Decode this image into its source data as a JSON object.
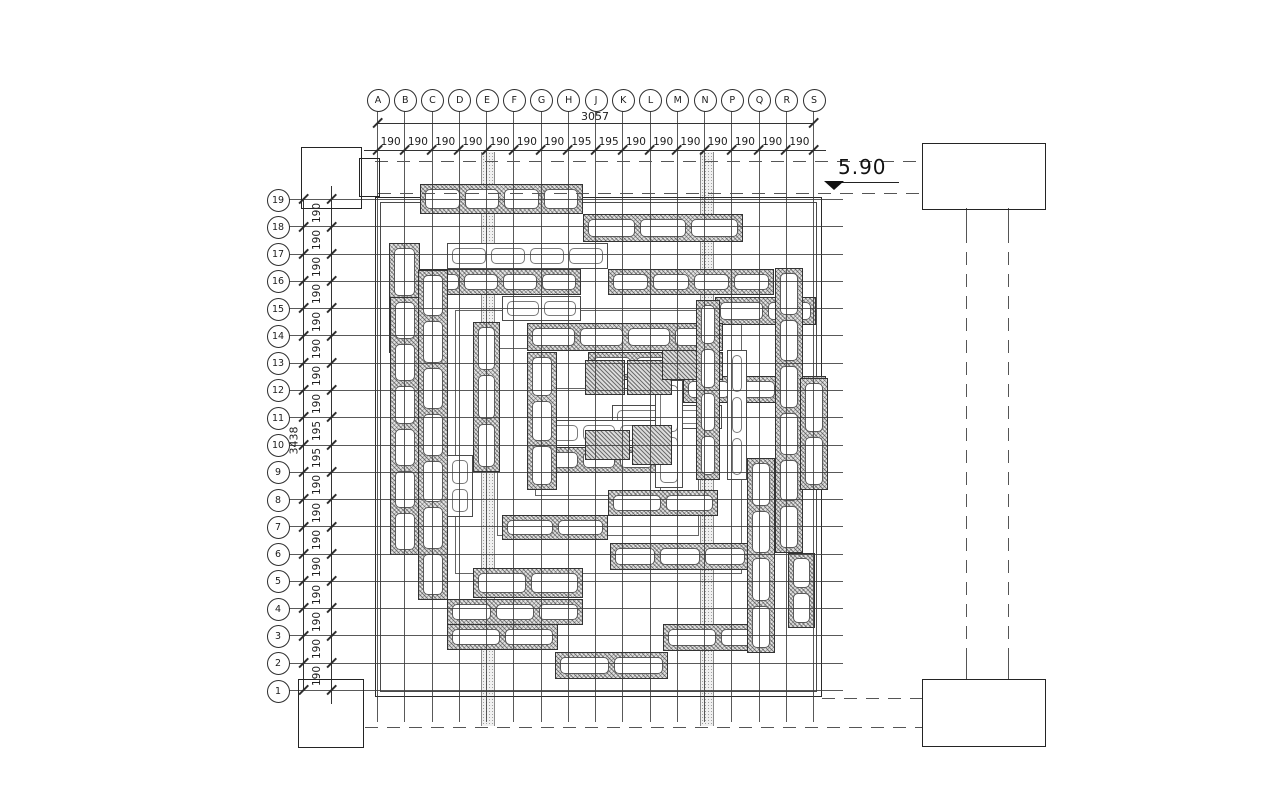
{
  "elevation": {
    "value": "5.90"
  },
  "grid": {
    "top": {
      "labels": [
        "A",
        "B",
        "C",
        "D",
        "E",
        "F",
        "G",
        "H",
        "J",
        "K",
        "L",
        "M",
        "N",
        "P",
        "Q",
        "R",
        "S"
      ],
      "segments": [
        "190",
        "190",
        "190",
        "190",
        "190",
        "190",
        "190",
        "195",
        "195",
        "190",
        "190",
        "190",
        "190",
        "190",
        "190",
        "190"
      ],
      "total": "3057"
    },
    "left": {
      "labels": [
        "19",
        "18",
        "17",
        "16",
        "15",
        "14",
        "13",
        "12",
        "11",
        "10",
        "9",
        "8",
        "7",
        "6",
        "5",
        "4",
        "3",
        "2",
        "1"
      ],
      "segments": [
        "190",
        "190",
        "190",
        "190",
        "190",
        "190",
        "190",
        "190",
        "195",
        "195",
        "190",
        "190",
        "190",
        "190",
        "190",
        "190",
        "190",
        "190"
      ],
      "total": "3438"
    }
  },
  "plan": {
    "boundary": {
      "x": 375,
      "y": 197,
      "w": 445,
      "h": 498
    },
    "bands": [
      {
        "x": 481,
        "y": 152,
        "w": 12,
        "h": 574
      },
      {
        "x": 700,
        "y": 152,
        "w": 12,
        "h": 574
      }
    ],
    "strips": [
      {
        "x": 420,
        "y": 184,
        "w": 163,
        "h": 30,
        "o": "h",
        "s": "dark"
      },
      {
        "x": 583,
        "y": 214,
        "w": 160,
        "h": 28,
        "o": "h",
        "s": "dark"
      },
      {
        "x": 447,
        "y": 243,
        "w": 161,
        "h": 26,
        "o": "h",
        "s": "light"
      },
      {
        "x": 420,
        "y": 269,
        "w": 161,
        "h": 26,
        "o": "h",
        "s": "dark"
      },
      {
        "x": 608,
        "y": 269,
        "w": 166,
        "h": 26,
        "o": "h",
        "s": "dark"
      },
      {
        "x": 502,
        "y": 296,
        "w": 79,
        "h": 25,
        "o": "h",
        "s": "light"
      },
      {
        "x": 715,
        "y": 297,
        "w": 101,
        "h": 28,
        "o": "h",
        "s": "dark"
      },
      {
        "x": 527,
        "y": 323,
        "w": 196,
        "h": 28,
        "o": "h",
        "s": "dark"
      },
      {
        "x": 683,
        "y": 376,
        "w": 143,
        "h": 27,
        "o": "h",
        "s": "dark"
      },
      {
        "x": 612,
        "y": 405,
        "w": 110,
        "h": 24,
        "o": "h",
        "s": "light"
      },
      {
        "x": 540,
        "y": 420,
        "w": 118,
        "h": 26,
        "o": "h",
        "s": "light"
      },
      {
        "x": 540,
        "y": 447,
        "w": 118,
        "h": 26,
        "o": "h",
        "s": "dark"
      },
      {
        "x": 608,
        "y": 490,
        "w": 110,
        "h": 26,
        "o": "h",
        "s": "dark"
      },
      {
        "x": 502,
        "y": 515,
        "w": 106,
        "h": 25,
        "o": "h",
        "s": "dark"
      },
      {
        "x": 610,
        "y": 543,
        "w": 140,
        "h": 27,
        "o": "h",
        "s": "dark"
      },
      {
        "x": 473,
        "y": 568,
        "w": 110,
        "h": 30,
        "o": "h",
        "s": "dark"
      },
      {
        "x": 447,
        "y": 599,
        "w": 136,
        "h": 26,
        "o": "h",
        "s": "dark"
      },
      {
        "x": 447,
        "y": 624,
        "w": 111,
        "h": 26,
        "o": "h",
        "s": "dark"
      },
      {
        "x": 663,
        "y": 624,
        "w": 110,
        "h": 27,
        "o": "h",
        "s": "dark"
      },
      {
        "x": 555,
        "y": 652,
        "w": 113,
        "h": 27,
        "o": "h",
        "s": "dark"
      },
      {
        "x": 588,
        "y": 352,
        "w": 135,
        "h": 28,
        "o": "h",
        "s": "dark"
      },
      {
        "x": 389,
        "y": 243,
        "w": 31,
        "h": 110,
        "o": "v",
        "s": "dark"
      },
      {
        "x": 390,
        "y": 297,
        "w": 30,
        "h": 258,
        "o": "v",
        "s": "dark"
      },
      {
        "x": 418,
        "y": 270,
        "w": 30,
        "h": 330,
        "o": "v",
        "s": "dark"
      },
      {
        "x": 447,
        "y": 455,
        "w": 26,
        "h": 62,
        "o": "v",
        "s": "light"
      },
      {
        "x": 473,
        "y": 322,
        "w": 27,
        "h": 150,
        "o": "v",
        "s": "dark"
      },
      {
        "x": 527,
        "y": 352,
        "w": 30,
        "h": 138,
        "o": "v",
        "s": "dark"
      },
      {
        "x": 655,
        "y": 380,
        "w": 28,
        "h": 108,
        "o": "v",
        "s": "light"
      },
      {
        "x": 696,
        "y": 300,
        "w": 24,
        "h": 180,
        "o": "v",
        "s": "dark"
      },
      {
        "x": 727,
        "y": 350,
        "w": 20,
        "h": 130,
        "o": "v",
        "s": "light"
      },
      {
        "x": 747,
        "y": 458,
        "w": 28,
        "h": 195,
        "o": "v",
        "s": "dark"
      },
      {
        "x": 775,
        "y": 268,
        "w": 28,
        "h": 285,
        "o": "v",
        "s": "dark"
      },
      {
        "x": 800,
        "y": 378,
        "w": 28,
        "h": 112,
        "o": "v",
        "s": "dark"
      },
      {
        "x": 788,
        "y": 553,
        "w": 27,
        "h": 75,
        "o": "v",
        "s": "dark"
      }
    ],
    "rings": [
      {
        "x": 455,
        "y": 310,
        "w": 285,
        "h": 262
      },
      {
        "x": 497,
        "y": 348,
        "w": 200,
        "h": 186
      },
      {
        "x": 535,
        "y": 388,
        "w": 124,
        "h": 106
      }
    ],
    "blocks": [
      {
        "x": 585,
        "y": 360,
        "w": 40,
        "h": 35
      },
      {
        "x": 627,
        "y": 360,
        "w": 45,
        "h": 35
      },
      {
        "x": 585,
        "y": 430,
        "w": 45,
        "h": 30
      },
      {
        "x": 632,
        "y": 425,
        "w": 40,
        "h": 40
      },
      {
        "x": 662,
        "y": 350,
        "w": 35,
        "h": 30
      }
    ]
  },
  "corner_blocks": [
    {
      "name": "top-left",
      "x": 301,
      "y": 147,
      "w": 59,
      "h": 60
    },
    {
      "name": "top-left-tab",
      "x": 359,
      "y": 158,
      "w": 19,
      "h": 37
    },
    {
      "name": "top-right",
      "x": 922,
      "y": 143,
      "w": 122,
      "h": 65
    },
    {
      "name": "bottom-left",
      "x": 298,
      "y": 679,
      "w": 64,
      "h": 67
    },
    {
      "name": "bottom-right",
      "x": 922,
      "y": 679,
      "w": 122,
      "h": 66
    }
  ],
  "dashed_lines": [
    {
      "o": "h",
      "x": 375,
      "y": 161,
      "len": 545
    },
    {
      "o": "h",
      "x": 378,
      "y": 193,
      "len": 544
    },
    {
      "o": "h",
      "x": 822,
      "y": 698,
      "len": 100
    },
    {
      "o": "h",
      "x": 365,
      "y": 727,
      "len": 557
    },
    {
      "o": "v",
      "x": 966,
      "y": 230,
      "len": 430
    },
    {
      "o": "v",
      "x": 1008,
      "y": 230,
      "len": 430
    }
  ],
  "stubs": [
    {
      "x": 966,
      "y": 208,
      "len": 24
    },
    {
      "x": 1008,
      "y": 208,
      "len": 24
    },
    {
      "x": 966,
      "y": 657,
      "len": 22
    },
    {
      "x": 1008,
      "y": 657,
      "len": 22
    }
  ],
  "colors": {
    "line": "#3a3a3a",
    "hatch_fill": "#e2e2e2",
    "band_fill": "#f0f0f0"
  }
}
